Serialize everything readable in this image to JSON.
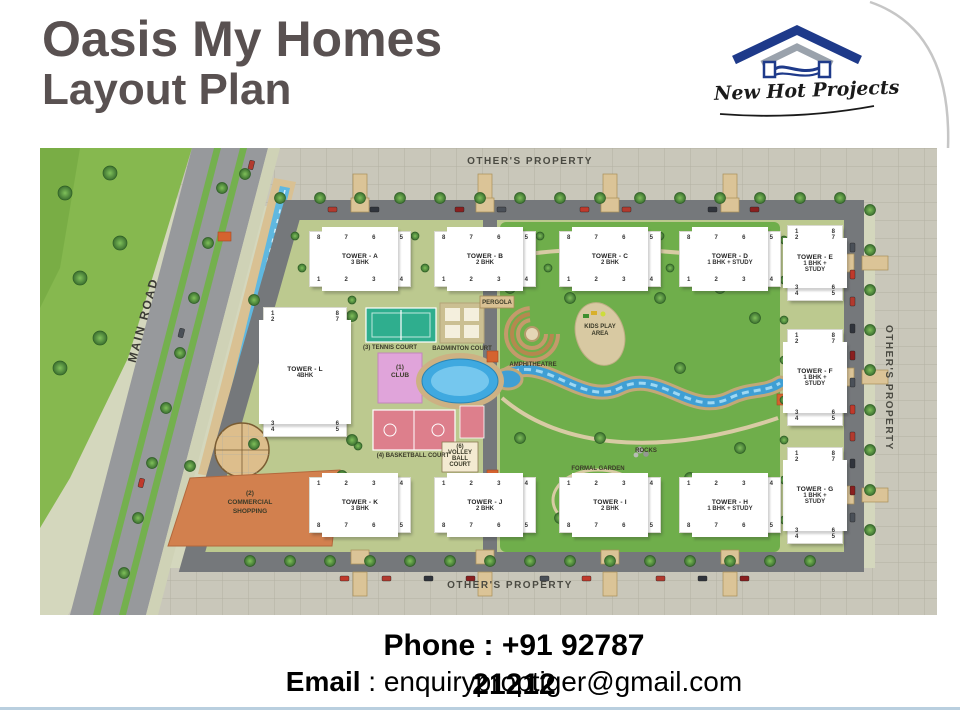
{
  "slide": {
    "title_line1": "Oasis My Homes",
    "title_line2": "Layout Plan",
    "logo": {
      "brand": "New Hot Projects"
    },
    "contact": {
      "phone_line1": "Phone : +91 92787",
      "phone_line2": "21212",
      "email_label": "Email",
      "email_sep": " : ",
      "email_value": "enquiryproptiger@gmail.com"
    }
  },
  "map": {
    "labels": {
      "others_property_top": "OTHER'S PROPERTY",
      "others_property_right": "OTHER'S PROPERTY",
      "others_property_bottom": "OTHER'S PROPERTY",
      "main_road": "MAIN ROAD",
      "tennis": "(3) TENNIS COURT",
      "badminton": "BADMINTON COURT",
      "club_line1": "(1)",
      "club_line2": "CLUB",
      "basketball": "(4) BASKETBALL COURT",
      "volley_line1": "(6)",
      "volley_line2": "VOLLEY",
      "volley_line3": "BALL",
      "volley_line4": "COURT",
      "pergola": "PERGOLA",
      "amphitheatre": "AMPHITHEATRE",
      "kids": "KIDS PLAY AREA",
      "formal_garden": "FORMAL GARDEN",
      "rocks": "ROCKS",
      "commercial_line1": "(2)",
      "commercial_line2": "COMMERCIAL",
      "commercial_line3": "SHOPPING"
    },
    "towers": [
      {
        "id": "a",
        "orient": "h",
        "x": 270,
        "y": 84,
        "w": 100,
        "h": 54,
        "name": "TOWER - A",
        "type": "3 BHK",
        "top": [
          "8",
          "7",
          "6",
          "5"
        ],
        "bottom": [
          "1",
          "2",
          "3",
          "4"
        ]
      },
      {
        "id": "b",
        "orient": "h",
        "x": 395,
        "y": 84,
        "w": 100,
        "h": 54,
        "name": "TOWER - B",
        "type": "2 BHK",
        "top": [
          "8",
          "7",
          "6",
          "5"
        ],
        "bottom": [
          "1",
          "2",
          "3",
          "4"
        ]
      },
      {
        "id": "c",
        "orient": "h",
        "x": 520,
        "y": 84,
        "w": 100,
        "h": 54,
        "name": "TOWER - C",
        "type": "2 BHK",
        "top": [
          "8",
          "7",
          "6",
          "5"
        ],
        "bottom": [
          "1",
          "2",
          "3",
          "4"
        ]
      },
      {
        "id": "d",
        "orient": "h",
        "x": 640,
        "y": 84,
        "w": 100,
        "h": 54,
        "name": "TOWER - D",
        "type": "1 BHK + STUDY",
        "top": [
          "8",
          "7",
          "6",
          "5"
        ],
        "bottom": [
          "1",
          "2",
          "3",
          "4"
        ]
      },
      {
        "id": "e",
        "orient": "v",
        "x": 748,
        "y": 78,
        "w": 54,
        "h": 74,
        "name": "TOWER - E",
        "type": "1 BHK + STUDY",
        "rows": [
          [
            "1",
            "8"
          ],
          [
            "2",
            "7"
          ],
          [
            "3",
            "6"
          ],
          [
            "4",
            "5"
          ]
        ]
      },
      {
        "id": "f",
        "orient": "v",
        "x": 748,
        "y": 182,
        "w": 54,
        "h": 95,
        "name": "TOWER - F",
        "type": "1 BHK + STUDY",
        "rows": [
          [
            "1",
            "8"
          ],
          [
            "2",
            "7"
          ],
          [
            "3",
            "6"
          ],
          [
            "4",
            "5"
          ]
        ]
      },
      {
        "id": "g",
        "orient": "v",
        "x": 748,
        "y": 300,
        "w": 54,
        "h": 95,
        "name": "TOWER - G",
        "type": "1 BHK + STUDY",
        "rows": [
          [
            "1",
            "8"
          ],
          [
            "2",
            "7"
          ],
          [
            "3",
            "6"
          ],
          [
            "4",
            "5"
          ]
        ]
      },
      {
        "id": "l",
        "orient": "v",
        "x": 224,
        "y": 160,
        "w": 82,
        "h": 128,
        "name": "TOWER - L",
        "type": "4BHK",
        "rows": [
          [
            "1",
            "8"
          ],
          [
            "2",
            "7"
          ],
          [
            "3",
            "6"
          ],
          [
            "4",
            "5"
          ]
        ]
      },
      {
        "id": "k",
        "orient": "h",
        "x": 270,
        "y": 330,
        "w": 100,
        "h": 54,
        "name": "TOWER - K",
        "type": "3 BHK",
        "top": [
          "1",
          "2",
          "3",
          "4"
        ],
        "bottom": [
          "8",
          "7",
          "6",
          "5"
        ]
      },
      {
        "id": "j",
        "orient": "h",
        "x": 395,
        "y": 330,
        "w": 100,
        "h": 54,
        "name": "TOWER - J",
        "type": "2 BHK",
        "top": [
          "1",
          "2",
          "3",
          "4"
        ],
        "bottom": [
          "8",
          "7",
          "6",
          "5"
        ]
      },
      {
        "id": "i",
        "orient": "h",
        "x": 520,
        "y": 330,
        "w": 100,
        "h": 54,
        "name": "TOWER - I",
        "type": "2 BHK",
        "top": [
          "1",
          "2",
          "3",
          "4"
        ],
        "bottom": [
          "8",
          "7",
          "6",
          "5"
        ]
      },
      {
        "id": "h",
        "orient": "h",
        "x": 640,
        "y": 330,
        "w": 100,
        "h": 54,
        "name": "TOWER - H",
        "type": "1 BHK + STUDY",
        "top": [
          "1",
          "2",
          "3",
          "4"
        ],
        "bottom": [
          "8",
          "7",
          "6",
          "5"
        ]
      }
    ]
  },
  "colors": {
    "title_gray": "#595151",
    "logo_navy": "#1e3a8a",
    "logo_gray": "#9aa2ac",
    "park_green": "#6fae4b",
    "road_gray": "#97999c",
    "band_gray": "#c9c7ba",
    "tennis_teal": "#2fae8e",
    "club_pink": "#e0a4da",
    "court_pink": "#dd7f8c",
    "pool_blue": "#3fa9e0",
    "commercial_orange": "#d2804e",
    "footer_blue": "#b9cfdf"
  },
  "decor": {
    "trees": [
      [
        240,
        50
      ],
      [
        280,
        50
      ],
      [
        320,
        50
      ],
      [
        360,
        50
      ],
      [
        400,
        50
      ],
      [
        440,
        50
      ],
      [
        480,
        50
      ],
      [
        520,
        50
      ],
      [
        560,
        50
      ],
      [
        600,
        50
      ],
      [
        640,
        50
      ],
      [
        680,
        50
      ],
      [
        720,
        50
      ],
      [
        760,
        50
      ],
      [
        800,
        50
      ],
      [
        205,
        26
      ],
      [
        255,
        88,
        4
      ],
      [
        375,
        88,
        4
      ],
      [
        500,
        88,
        4
      ],
      [
        620,
        88,
        4
      ],
      [
        735,
        88,
        4
      ],
      [
        262,
        120,
        4
      ],
      [
        385,
        120,
        4
      ],
      [
        508,
        120,
        4
      ],
      [
        630,
        120,
        4
      ],
      [
        830,
        62
      ],
      [
        830,
        102
      ],
      [
        830,
        142
      ],
      [
        830,
        182
      ],
      [
        830,
        222
      ],
      [
        830,
        262
      ],
      [
        830,
        302
      ],
      [
        830,
        342
      ],
      [
        830,
        382
      ],
      [
        744,
        92,
        4
      ],
      [
        744,
        132,
        4
      ],
      [
        744,
        172,
        4
      ],
      [
        744,
        212,
        4
      ],
      [
        744,
        252,
        4
      ],
      [
        744,
        292,
        4
      ],
      [
        744,
        332,
        4
      ],
      [
        744,
        372,
        4
      ],
      [
        210,
        413
      ],
      [
        250,
        413
      ],
      [
        290,
        413
      ],
      [
        330,
        413
      ],
      [
        370,
        413
      ],
      [
        410,
        413
      ],
      [
        450,
        413
      ],
      [
        490,
        413
      ],
      [
        530,
        413
      ],
      [
        570,
        413
      ],
      [
        610,
        413
      ],
      [
        650,
        413
      ],
      [
        690,
        413
      ],
      [
        730,
        413
      ],
      [
        770,
        413
      ],
      [
        25,
        45,
        7
      ],
      [
        70,
        25,
        7
      ],
      [
        40,
        130,
        7
      ],
      [
        80,
        95,
        7
      ],
      [
        20,
        220,
        7
      ],
      [
        60,
        190,
        7
      ],
      [
        182,
        40
      ],
      [
        168,
        95
      ],
      [
        154,
        150
      ],
      [
        140,
        205
      ],
      [
        126,
        260
      ],
      [
        112,
        315
      ],
      [
        98,
        370
      ],
      [
        84,
        425
      ],
      [
        470,
        140
      ],
      [
        530,
        150
      ],
      [
        620,
        150
      ],
      [
        680,
        140
      ],
      [
        715,
        170
      ],
      [
        700,
        300
      ],
      [
        650,
        330
      ],
      [
        600,
        370
      ],
      [
        520,
        370
      ],
      [
        480,
        290
      ],
      [
        560,
        290
      ],
      [
        640,
        220
      ],
      [
        312,
        152,
        4
      ],
      [
        302,
        242,
        4
      ],
      [
        318,
        298,
        4
      ],
      [
        214,
        152
      ],
      [
        312,
        168
      ],
      [
        214,
        296
      ],
      [
        312,
        292
      ],
      [
        150,
        318
      ],
      [
        302,
        328
      ]
    ],
    "cars": [
      [
        288,
        59,
        "h"
      ],
      [
        330,
        59,
        "h"
      ],
      [
        415,
        59,
        "h"
      ],
      [
        457,
        59,
        "h"
      ],
      [
        540,
        59,
        "h"
      ],
      [
        582,
        59,
        "h"
      ],
      [
        668,
        59,
        "h"
      ],
      [
        710,
        59,
        "h"
      ],
      [
        810,
        95,
        "v"
      ],
      [
        810,
        122,
        "v"
      ],
      [
        810,
        149,
        "v"
      ],
      [
        810,
        176,
        "v"
      ],
      [
        810,
        203,
        "v"
      ],
      [
        810,
        230,
        "v"
      ],
      [
        810,
        257,
        "v"
      ],
      [
        810,
        284,
        "v"
      ],
      [
        810,
        311,
        "v"
      ],
      [
        810,
        338,
        "v"
      ],
      [
        810,
        365,
        "v"
      ],
      [
        300,
        428,
        "h"
      ],
      [
        342,
        428,
        "h"
      ],
      [
        384,
        428,
        "h"
      ],
      [
        426,
        428,
        "h"
      ],
      [
        500,
        428,
        "h"
      ],
      [
        542,
        428,
        "h"
      ],
      [
        616,
        428,
        "h"
      ],
      [
        658,
        428,
        "h"
      ],
      [
        700,
        428,
        "h"
      ],
      [
        140,
        180,
        "d"
      ],
      [
        100,
        330,
        "d"
      ],
      [
        210,
        12,
        "d"
      ]
    ],
    "gates": [
      [
        313,
        26,
        14,
        26
      ],
      [
        438,
        26,
        14,
        26
      ],
      [
        563,
        26,
        14,
        26
      ],
      [
        683,
        26,
        14,
        26
      ],
      [
        311,
        50,
        18,
        14
      ],
      [
        436,
        50,
        18,
        14
      ],
      [
        561,
        50,
        18,
        14
      ],
      [
        681,
        50,
        18,
        14
      ],
      [
        311,
        402,
        18,
        14
      ],
      [
        436,
        402,
        18,
        14
      ],
      [
        561,
        402,
        18,
        14
      ],
      [
        681,
        402,
        18,
        14
      ],
      [
        313,
        424,
        14,
        24
      ],
      [
        438,
        424,
        14,
        24
      ],
      [
        563,
        424,
        14,
        24
      ],
      [
        683,
        424,
        14,
        24
      ],
      [
        798,
        106,
        16,
        18
      ],
      [
        798,
        220,
        16,
        18
      ],
      [
        798,
        338,
        16,
        18
      ],
      [
        822,
        108,
        26,
        14
      ],
      [
        822,
        222,
        26,
        14
      ],
      [
        822,
        340,
        26,
        14
      ],
      [
        246,
        208,
        16,
        14
      ]
    ],
    "markers": [
      [
        447,
        203,
        11,
        11
      ],
      [
        447,
        322,
        11,
        11
      ],
      [
        737,
        246,
        11,
        11
      ],
      [
        178,
        84,
        13,
        9
      ]
    ]
  }
}
